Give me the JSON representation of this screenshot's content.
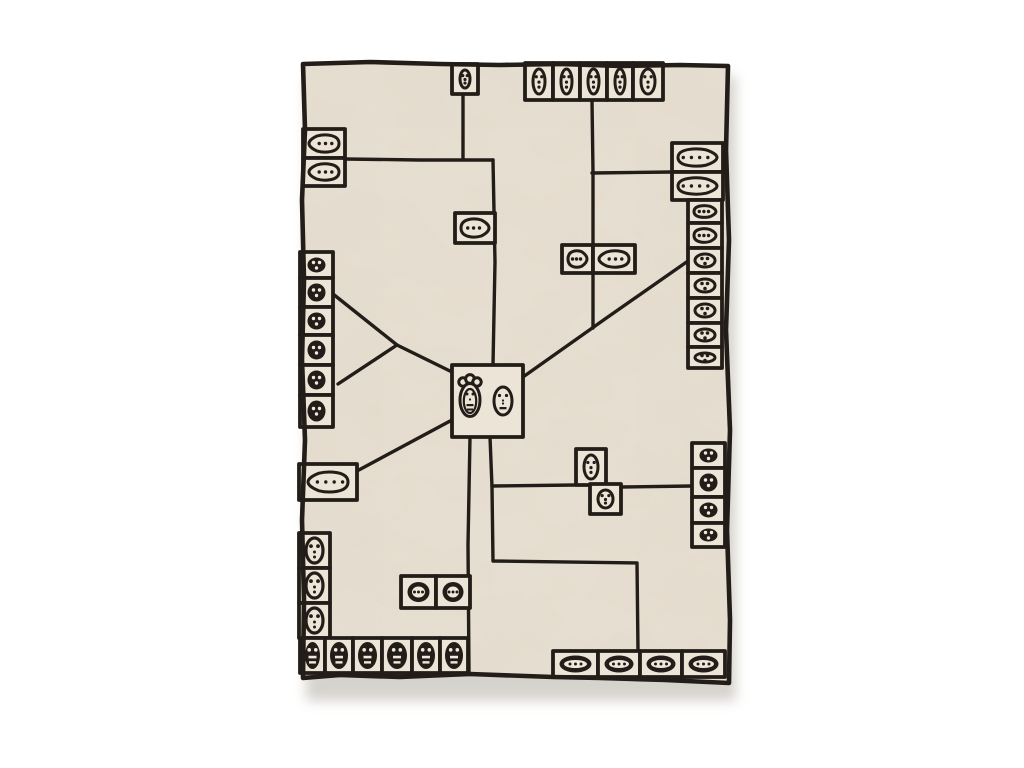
{
  "scene": {
    "page_background": "#ffffff",
    "rug": {
      "colors": {
        "base": "#e8e0d2",
        "box_fill": "#ece4d6",
        "line": "#221d18",
        "shadow": "#a59e92"
      },
      "frame": {
        "x": 300,
        "y": 60,
        "w": 430,
        "h": 625
      },
      "border_points": [
        [
          303,
          64
        ],
        [
          370,
          62
        ],
        [
          440,
          64
        ],
        [
          500,
          65
        ],
        [
          560,
          64
        ],
        [
          620,
          66
        ],
        [
          680,
          65
        ],
        [
          728,
          66
        ],
        [
          726,
          150
        ],
        [
          729,
          240
        ],
        [
          726,
          330
        ],
        [
          730,
          430
        ],
        [
          727,
          530
        ],
        [
          730,
          620
        ],
        [
          729,
          683
        ],
        [
          665,
          680
        ],
        [
          600,
          678
        ],
        [
          553,
          677
        ],
        [
          470,
          674
        ],
        [
          400,
          677
        ],
        [
          340,
          675
        ],
        [
          303,
          678
        ],
        [
          304,
          600
        ],
        [
          302,
          520
        ],
        [
          305,
          440
        ],
        [
          302,
          360
        ],
        [
          304,
          280
        ],
        [
          302,
          200
        ],
        [
          305,
          130
        ]
      ],
      "lines": [
        [
          [
            463,
            94
          ],
          [
            463,
            159
          ]
        ],
        [
          [
            345,
            159
          ],
          [
            420,
            160
          ],
          [
            493,
            160
          ]
        ],
        [
          [
            493,
            160
          ],
          [
            495,
            262
          ],
          [
            493,
            365
          ]
        ],
        [
          [
            592,
            100
          ],
          [
            593,
            172
          ],
          [
            593,
            328
          ]
        ],
        [
          [
            592,
            173
          ],
          [
            672,
            172
          ]
        ],
        [
          [
            523,
            377
          ],
          [
            605,
            319
          ],
          [
            688,
            261
          ]
        ],
        [
          [
            333,
            294
          ],
          [
            397,
            345
          ]
        ],
        [
          [
            397,
            345
          ],
          [
            338,
            384
          ]
        ],
        [
          [
            397,
            345
          ],
          [
            452,
            372
          ]
        ],
        [
          [
            357,
            471
          ],
          [
            452,
            420
          ]
        ],
        [
          [
            470,
            437
          ],
          [
            468,
            545
          ],
          [
            469,
            673
          ]
        ],
        [
          [
            490,
            437
          ],
          [
            492,
            487
          ],
          [
            493,
            561
          ],
          [
            637,
            563
          ],
          [
            638,
            651
          ]
        ],
        [
          [
            492,
            486
          ],
          [
            576,
            485
          ]
        ],
        [
          [
            621,
            487
          ],
          [
            692,
            486
          ]
        ]
      ],
      "boxes": [
        [
          452,
          64,
          26,
          30,
          "v-outline"
        ],
        [
          525,
          63,
          28,
          37,
          "v-outline"
        ],
        [
          553,
          63,
          27,
          37,
          "v-outline"
        ],
        [
          580,
          63,
          27,
          37,
          "v-outline"
        ],
        [
          607,
          63,
          26,
          37,
          "v-outline"
        ],
        [
          633,
          63,
          30,
          37,
          "v-outline"
        ],
        [
          303,
          129,
          42,
          29,
          "h-outline-l"
        ],
        [
          303,
          158,
          42,
          28,
          "h-outline-l"
        ],
        [
          300,
          252,
          33,
          26,
          "blob-filled"
        ],
        [
          300,
          278,
          33,
          29,
          "blob-filled"
        ],
        [
          300,
          307,
          33,
          28,
          "blob-filled"
        ],
        [
          300,
          335,
          33,
          30,
          "blob-filled"
        ],
        [
          300,
          365,
          33,
          30,
          "blob-filled"
        ],
        [
          300,
          395,
          33,
          32,
          "blob-filled"
        ],
        [
          299,
          464,
          58,
          36,
          "h-outline-l"
        ],
        [
          299,
          533,
          31,
          35,
          "ghost"
        ],
        [
          299,
          568,
          31,
          35,
          "ghost"
        ],
        [
          299,
          603,
          31,
          35,
          "ghost"
        ],
        [
          300,
          638,
          25,
          35,
          "v-filled"
        ],
        [
          325,
          638,
          28,
          35,
          "v-filled"
        ],
        [
          353,
          638,
          29,
          35,
          "v-filled"
        ],
        [
          382,
          638,
          30,
          35,
          "v-filled"
        ],
        [
          412,
          638,
          28,
          35,
          "v-filled"
        ],
        [
          440,
          638,
          28,
          35,
          "v-filled"
        ],
        [
          455,
          213,
          40,
          30,
          "h-outline-r"
        ],
        [
          562,
          245,
          31,
          28,
          "h-outline-r"
        ],
        [
          593,
          245,
          42,
          28,
          "h-outline-l"
        ],
        [
          672,
          143,
          51,
          29,
          "h-outline-r"
        ],
        [
          672,
          172,
          51,
          28,
          "h-outline-r"
        ],
        [
          688,
          200,
          34,
          23,
          "h-outline-r"
        ],
        [
          688,
          223,
          34,
          25,
          "h-outline-r"
        ],
        [
          688,
          248,
          34,
          25,
          "h-egg"
        ],
        [
          688,
          273,
          34,
          25,
          "h-egg"
        ],
        [
          688,
          298,
          34,
          25,
          "h-egg"
        ],
        [
          688,
          323,
          34,
          24,
          "h-egg"
        ],
        [
          688,
          347,
          34,
          21,
          "h-egg"
        ],
        [
          692,
          443,
          33,
          25,
          "blob-filled"
        ],
        [
          692,
          468,
          33,
          29,
          "blob-filled"
        ],
        [
          692,
          497,
          33,
          26,
          "blob-filled"
        ],
        [
          692,
          523,
          33,
          24,
          "blob-filled"
        ],
        [
          576,
          449,
          30,
          36,
          "v-outline"
        ],
        [
          590,
          484,
          31,
          30,
          "v-outline"
        ],
        [
          401,
          576,
          35,
          32,
          "h-filled"
        ],
        [
          436,
          576,
          34,
          32,
          "h-filled"
        ],
        [
          553,
          651,
          45,
          26,
          "h-filled"
        ],
        [
          598,
          651,
          42,
          26,
          "h-filled"
        ],
        [
          640,
          651,
          42,
          26,
          "h-filled"
        ],
        [
          682,
          651,
          43,
          26,
          "h-filled"
        ],
        [
          452,
          365,
          71,
          72,
          "center"
        ]
      ]
    }
  }
}
